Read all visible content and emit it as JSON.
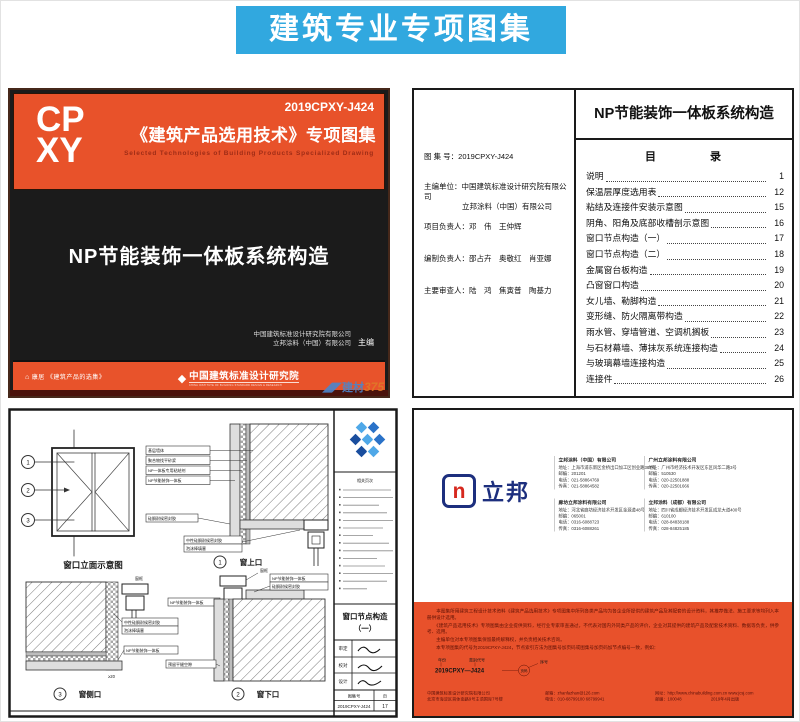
{
  "banner": {
    "title": "建筑专业专项图集"
  },
  "colors": {
    "banner_blue": "#31A8DF",
    "cover_orange": "#E8522A",
    "cover_black": "#1B1B1B",
    "orange_section": "#E8512B",
    "nippon_navy": "#1D2F7E",
    "nippon_red": "#D6281E",
    "titleblock_blue": "#2A72C8"
  },
  "cover": {
    "logo_line1": "CP",
    "logo_line2": "XY",
    "code": "2019CPXY-J424",
    "series_title": "《建筑产品选用技术》专项图集",
    "series_subtitle_en": "Selected Technologies of Building Products Specialized Drawing",
    "main_title": "NP节能装饰一体板系统构造",
    "editor_line1": "中国建筑标准设计研究院有限公司",
    "editor_line2": "立邦涂料（中国）有限公司",
    "editor_role": "主编",
    "footer_left": "康居 《建筑产品的选集》",
    "footer_right": "中国建筑标准设计研究院",
    "footer_right_sub": "CHINA INSTITUTE OF BUILDING STANDARD DESIGN & RESEARCH",
    "watermark_cn": "建材",
    "watermark_num": "375"
  },
  "toc": {
    "page_title": "NP节能装饰一体板系统构造",
    "heading": "目　　　　录",
    "atlas_label": "图 集 号：",
    "atlas_value": "2019CPXY-J424",
    "chief_label": "主编单位：",
    "chief_value1": "中国建筑标准设计研究院有限公司",
    "chief_value2": "立邦涂料（中国）有限公司",
    "pm_label": "项目负责人：",
    "pm_value": "邓　伟　王仲辉",
    "comp_label": "编制负责人：",
    "comp_value": "邵占卉　奥敬红　肖亚娜",
    "review_label": "主要审查人：",
    "review_value": "陆　鸿　焦寅普　陶基力",
    "items": [
      {
        "label": "说明",
        "page": "1"
      },
      {
        "label": "保温层厚度选用表",
        "page": "12"
      },
      {
        "label": "粘结及连接件安装示意图",
        "page": "15"
      },
      {
        "label": "阴角、阳角及底部收槽剖示意图",
        "page": "16"
      },
      {
        "label": "窗口节点构造（一）",
        "page": "17"
      },
      {
        "label": "窗口节点构造（二）",
        "page": "18"
      },
      {
        "label": "金属窗台板构造",
        "page": "19"
      },
      {
        "label": "凸窗窗口构造",
        "page": "20"
      },
      {
        "label": "女儿墙、勒脚构造",
        "page": "21"
      },
      {
        "label": "变形缝、防火隔离带构造",
        "page": "22"
      },
      {
        "label": "雨水管、穿墙管道、空调机搁板",
        "page": "23"
      },
      {
        "label": "与石材幕墙、薄抹灰系统连接构造",
        "page": "24"
      },
      {
        "label": "与玻璃幕墙连接构造",
        "page": "25"
      },
      {
        "label": "连接件",
        "page": "26"
      }
    ]
  },
  "drawing": {
    "elevation_caption": "窗口立面示意图",
    "markers": [
      "1",
      "2",
      "3"
    ],
    "layers": [
      "基层墙体",
      "聚合物找平砂浆",
      "NP一体板专用粘结剂",
      "NP节能装饰一体板"
    ],
    "label_sealant": "硅酮耐候密封胶",
    "label_sealant2_l1": "中性硅酮耐候密封胶",
    "label_sealant2_l2": "泡沫棒填塞",
    "label_frame": "窗框",
    "label_board": "NP节能装饰一体板",
    "label_gap": "预留平缝空隙",
    "dim1": "≥20",
    "detail1_no": "1",
    "detail1_caption": "窗上口",
    "detail2_no": "2",
    "detail2_caption": "窗下口",
    "detail3_no": "3",
    "detail3_caption": "窗侧口",
    "titleblock": {
      "index_heading": "相关页次",
      "title_l1": "窗口节点构造",
      "title_l2": "（一）",
      "sig_row1": "审定",
      "sig_row2": "校对",
      "sig_row3": "设计",
      "atlas_label": "图集号",
      "atlas_value": "2019CPXY-J424",
      "page_label": "页",
      "page_value": "17"
    }
  },
  "backcover": {
    "brand": "立邦",
    "brand_glyph": "n",
    "companies": [
      {
        "col": 0,
        "name": "立邦涂料（中国）有限公司",
        "lines": [
          "地址：上海市浦东新区金桥出口加工区创业路387号",
          "邮编：201201",
          "电话：021-58864769",
          "传真：021-58864582"
        ]
      },
      {
        "col": 1,
        "name": "广州立邦涂料有限公司",
        "lines": [
          "地址：广州市经济技术开发区东区风华二路3号",
          "邮编：510530",
          "电话：020-22501888",
          "传真：020-22501666"
        ]
      },
      {
        "col": 0,
        "name": "廊坊立邦涂料有限公司",
        "lines": [
          "地址：河北省廊坊经济技术开发区金源道48号",
          "邮编：065001",
          "电话：0316-6088723",
          "传真：0316-6088261"
        ]
      },
      {
        "col": 1,
        "name": "立邦涂料（成都）有限公司",
        "lines": [
          "地址：四川省成都经济技术开发区成龙大道400号",
          "邮编：610100",
          "电话：028-84838188",
          "传真：028-84825185"
        ]
      }
    ],
    "notes": [
      "　　本图集所用建筑工程设计技术资料《建筑产品选用技术》专项图集中所列各类产品均为各企业所提供的建筑产品及其配套的设计资料，其推荐做法、施工要求等均列入本册供设计选用。",
      "　　《建筑产品选用技术》专项图集由企业提供资料，经行业专家审查通过，不代表对国内外同类产品的评价，企业对其提供的建筑产品及配套技术资料、数据等负责，供参考、选用。",
      "　　主编单位对本专项图集保留最终解释权，并负责相关技术咨询。",
      "　　本专项图集的代号为2019CPXY-J424，节点索引方法为图集号加页码或图集号加页码加节点编号一致，例如："
    ],
    "diagram": {
      "code": "2019CPXY—J424",
      "label_year": "年份",
      "label_type": "类别代号",
      "label_seq": "序号",
      "label_page": "页码"
    },
    "footer_cols": [
      [
        "中国建筑标准设计研究院有限公司",
        "北京市海淀区首体南路9号主语国际7号楼"
      ],
      [
        "邮箱：zhanfazhan@126.com",
        "电话：010-68799100  68799941"
      ],
      [
        "网址：http://www.chinabuilding.com.cn  www.jcsj.com",
        "邮编：100048　　　　　　　2019年4月出版"
      ]
    ]
  }
}
